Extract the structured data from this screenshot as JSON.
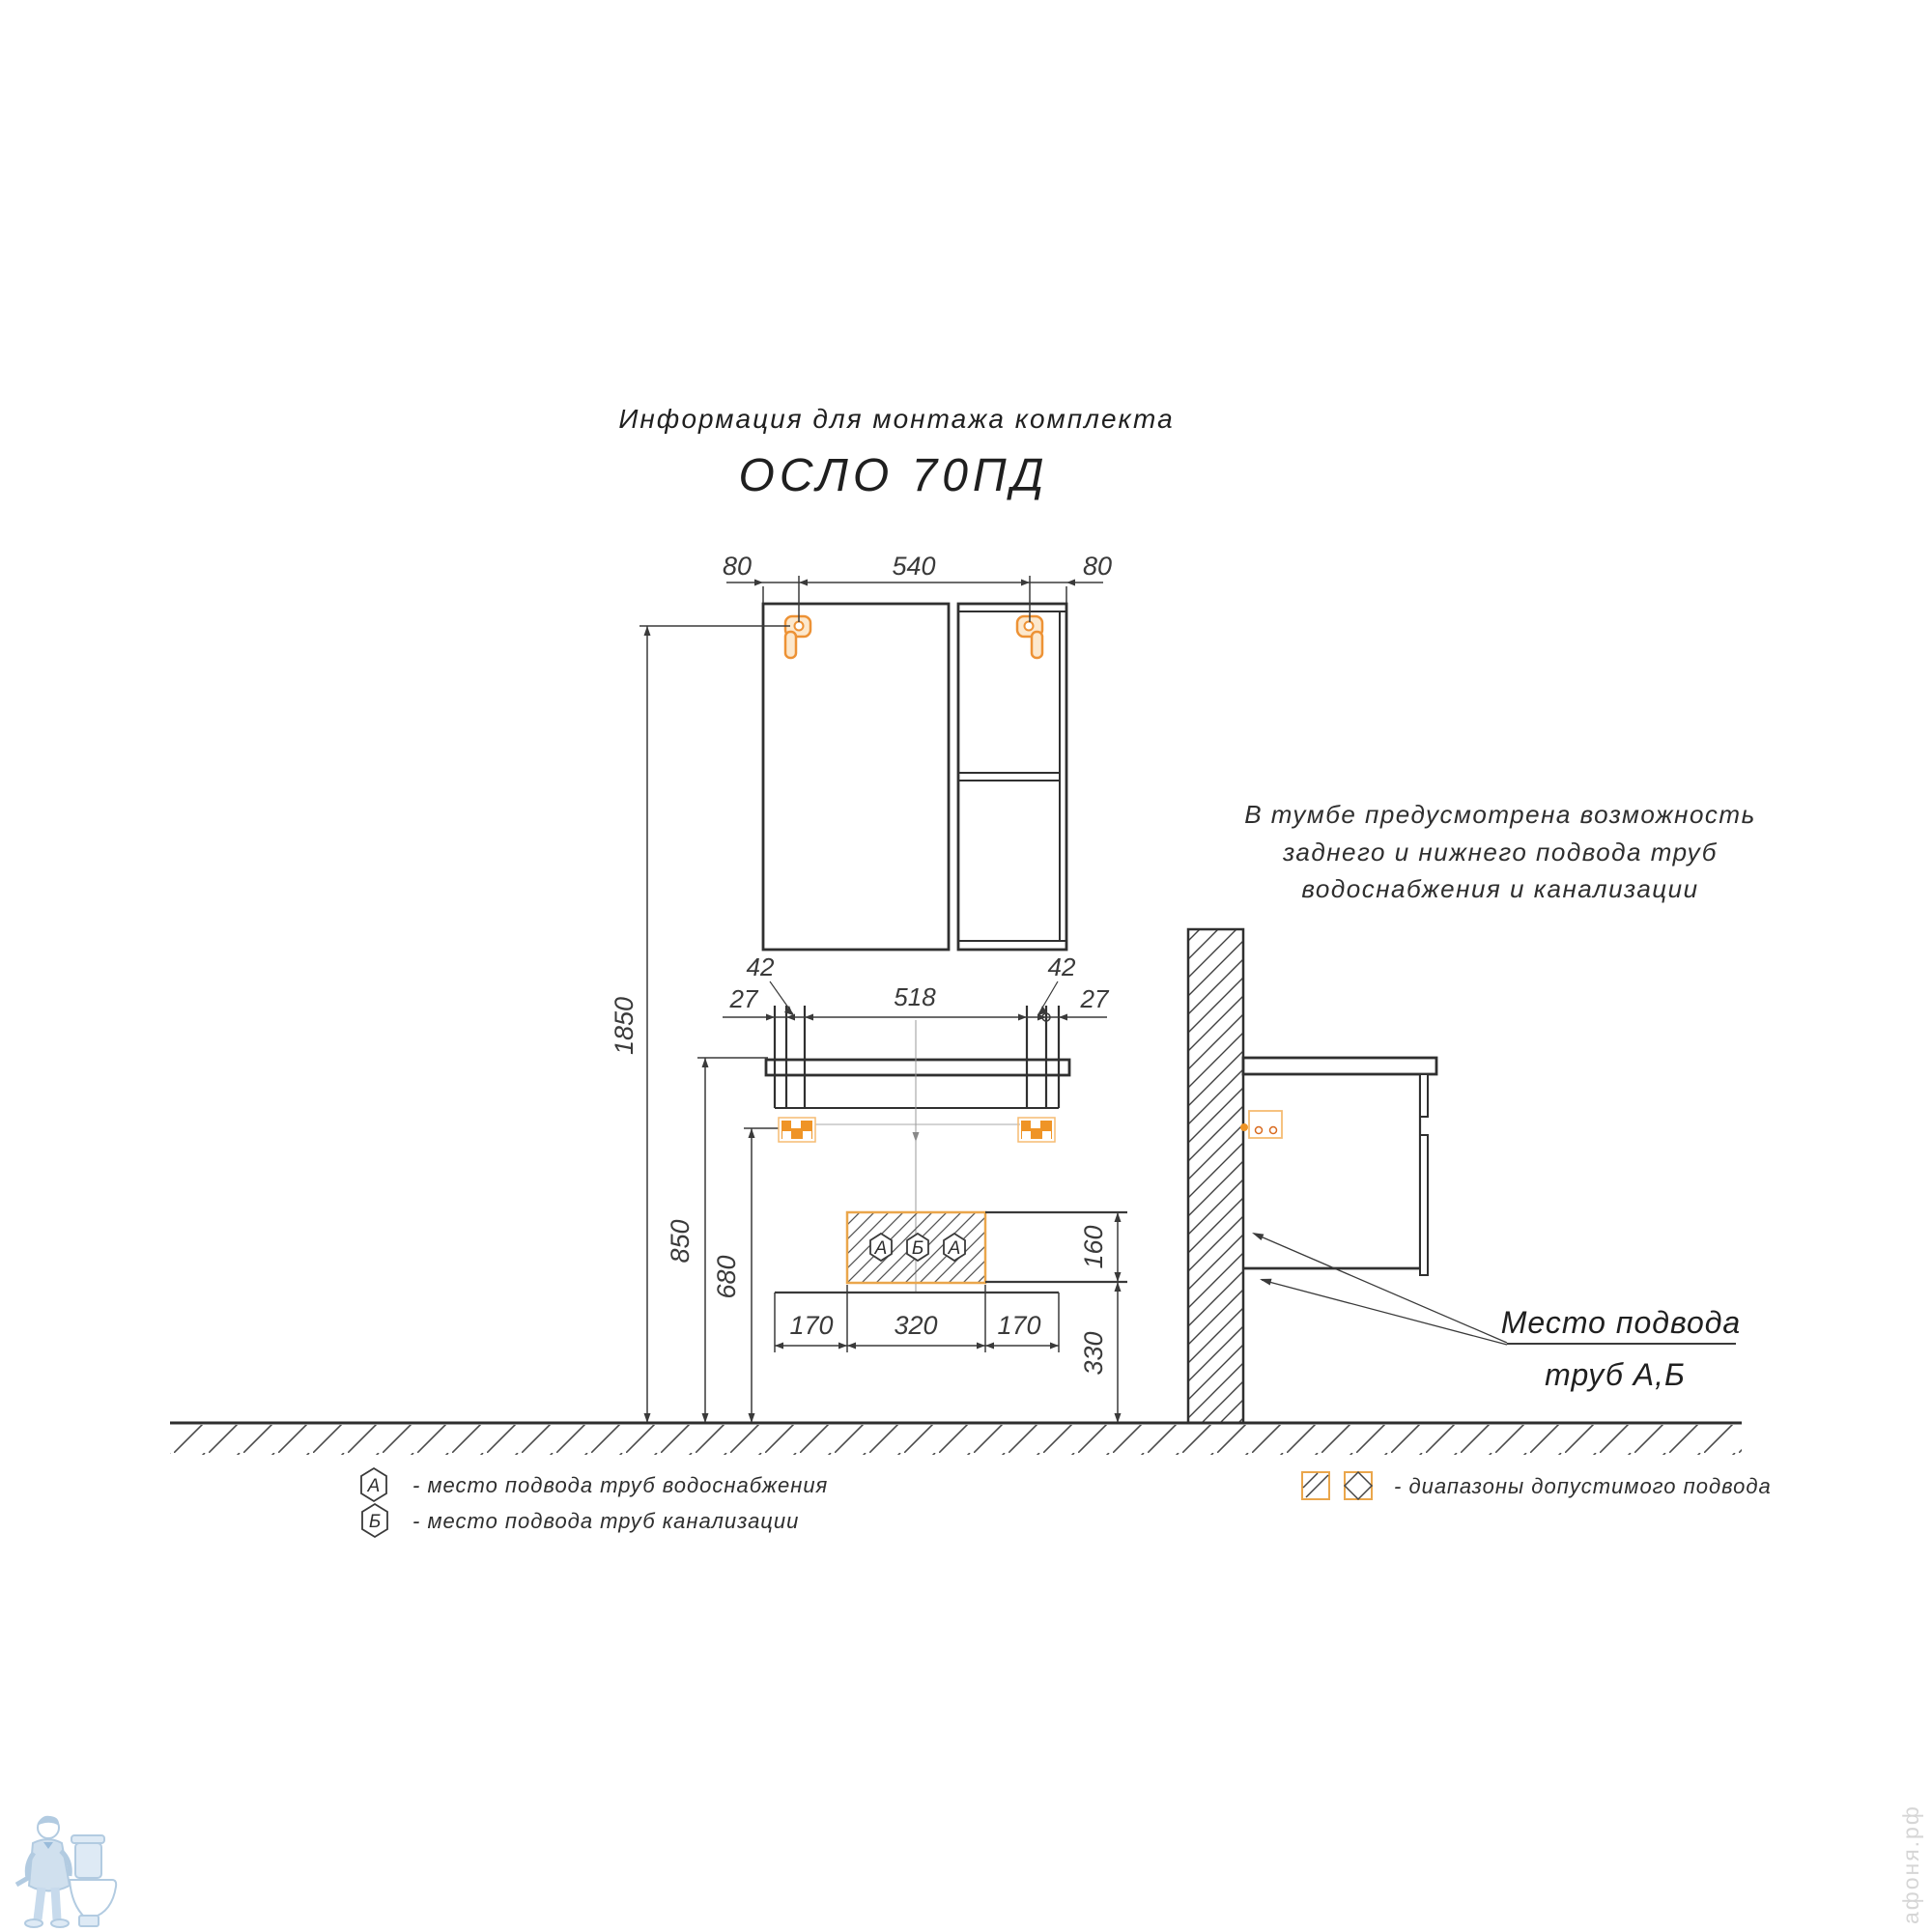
{
  "title": {
    "line1": "Информация для монтажа комплекта",
    "line2": "ОСЛО 70ПД"
  },
  "note": {
    "line1": "В тумбе предусмотрена возможность",
    "line2": "заднего и нижнего подвода труб",
    "line3": "водоснабжения и канализации"
  },
  "leader": {
    "line1": "Место подвода",
    "line2": "труб А,Б"
  },
  "dims": {
    "top_left_80": "80",
    "top_540": "540",
    "top_right_80": "80",
    "v27_left": "27",
    "v42_left": "42",
    "v518": "518",
    "v42_right": "42",
    "v27_right": "27",
    "h1850": "1850",
    "h850": "850",
    "h680": "680",
    "r160": "160",
    "r330": "330",
    "b170_left": "170",
    "b320": "320",
    "b170_right": "170"
  },
  "markers": {
    "left": "А",
    "center": "Б",
    "right": "А"
  },
  "legend_left": {
    "item1": {
      "symbol": "А",
      "label": "-  место подвода труб водоснабжения"
    },
    "item2": {
      "symbol": "Б",
      "label": "-  место подвода труб канализации"
    }
  },
  "legend_right": {
    "label": "-  диапазоны допустимого подвода"
  },
  "watermark": {
    "brand": "афоня.рф"
  },
  "colors": {
    "accent_orange": "#ef9426",
    "accent_orange_light": "#f5bc72",
    "hatch_border_orange": "#eaa64b",
    "line_dark": "#303030",
    "watermark_blue": "#aac6de",
    "watermark_gray": "#d6d6d6"
  }
}
